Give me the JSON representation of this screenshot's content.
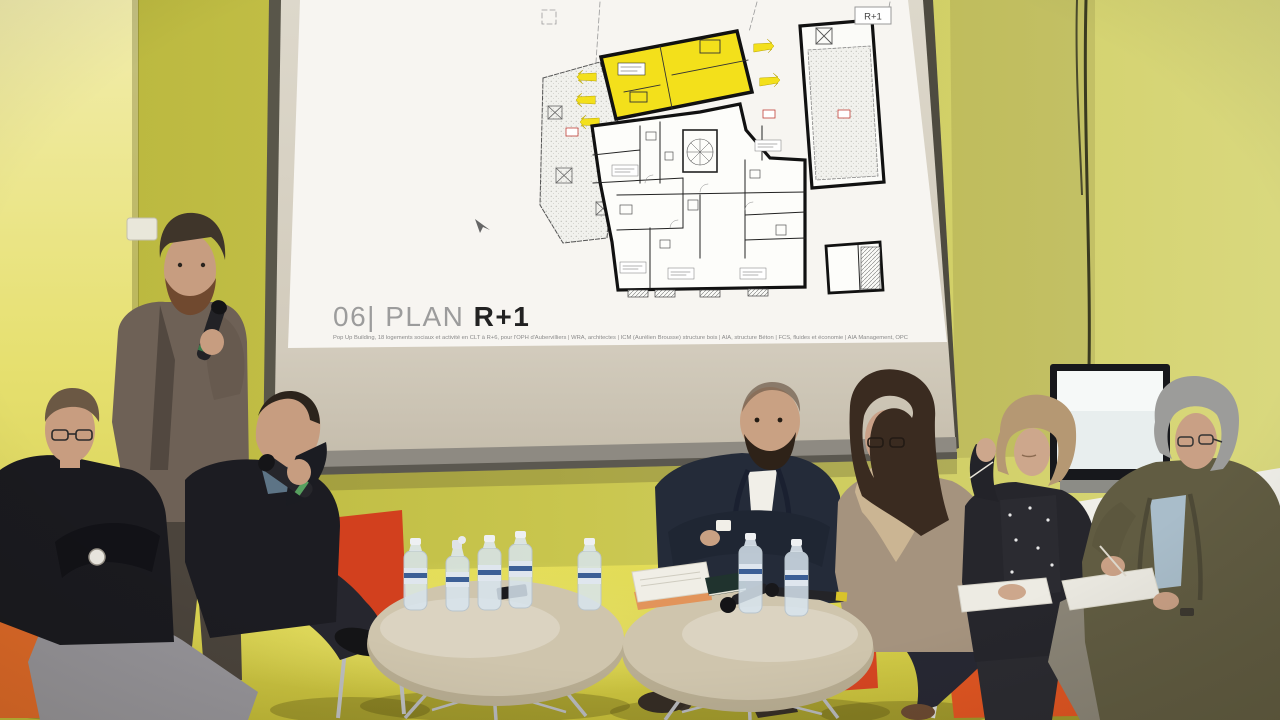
{
  "slide": {
    "title_prefix": "06| PLAN ",
    "title_bold": "R+1",
    "plan_tag": "R+1",
    "credit": "Pop Up Building, 18 logements sociaux et activité en CLT à R+6, pour l'OPH d'Aubervilliers | WRA, architectes | ICM (Aurélien Brousse) structure bois | AIA, structure Béton | FCS, fluides et économie | AIA Management, OPC"
  },
  "palette": {
    "wall": "#c6c348",
    "wall_light": "#dcdb8a",
    "column_yellow": "#eee89c",
    "floor": "#ddd64f",
    "screen_beige": "#d8d2c5",
    "screen_bar": "#8e8a82",
    "slide_white": "#f7f5f1",
    "plan_unit_yellow": "#f3e01b",
    "plan_wall_black": "#1a1a1a",
    "plan_red": "#c04038",
    "chair_red": "#d2401e",
    "chair_orange": "#e06a28",
    "table_top": "#cfc5ad",
    "title_grey": "#9c9c9c",
    "title_dark": "#222222",
    "credit_grey": "#8a8a8a",
    "suit_navy": "#242b39",
    "tweed_olive": "#615c42",
    "cardigan_taupe": "#a5937e",
    "scarf_beige": "#cbb593",
    "shirt_blue": "#a9bdca",
    "sweater_black": "#1c1c22",
    "trousers_grey": "#97959a",
    "jacket_brown": "#6e6156",
    "tv_screen": "#e8eeee"
  }
}
